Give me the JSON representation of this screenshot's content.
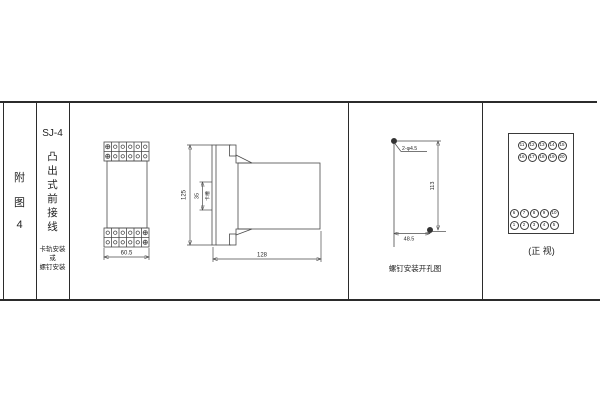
{
  "frame": {
    "bg": "#ffffff",
    "line_color": "#2b2b2b",
    "draw_color": "#4a4a4a"
  },
  "index_column": {
    "chars": [
      "附",
      "图",
      "4"
    ]
  },
  "title_column": {
    "model": "SJ-4",
    "title_chars": [
      "凸",
      "出",
      "式",
      "前",
      "接",
      "线"
    ],
    "mount_lines": [
      "卡轨安装",
      "或",
      "螺钉安装"
    ]
  },
  "front_view": {
    "width_dim": "60.5"
  },
  "side_view": {
    "height_dim": "125",
    "slot_dim": "35",
    "slot_label": "卡槽",
    "depth_dim": "128"
  },
  "drill_view": {
    "holes_label": "2-φ4.5",
    "height_dim": "113",
    "width_dim": "48.5",
    "caption": "螺钉安装开孔图"
  },
  "terminal_view": {
    "rows": [
      [
        "11",
        "12",
        "13",
        "14",
        "15"
      ],
      [
        "16",
        "17",
        "18",
        "19",
        "20"
      ],
      [
        "6",
        "7",
        "8",
        "9",
        "10"
      ],
      [
        "1",
        "2",
        "3",
        "4",
        "5"
      ]
    ],
    "caption": "(正 视)"
  }
}
